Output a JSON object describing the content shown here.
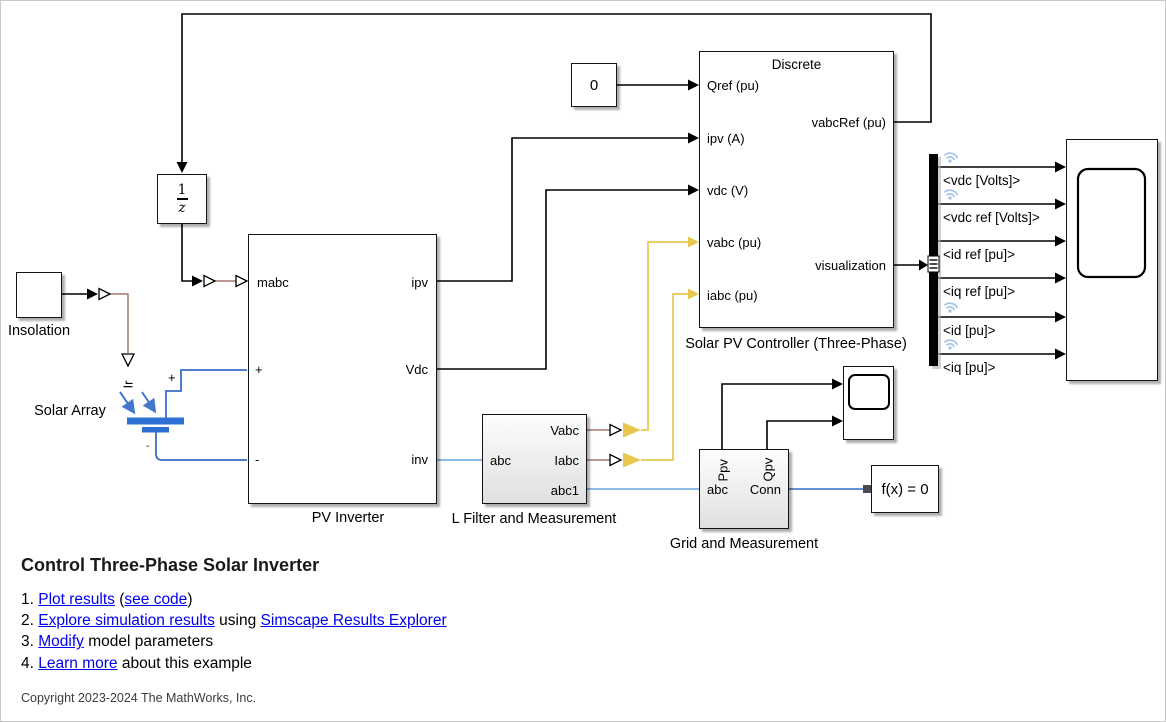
{
  "blocks": {
    "insolation": {
      "label": "Insolation"
    },
    "solar_array": {
      "label": "Solar Array",
      "ir_port": "Ir",
      "plus_label": "+",
      "minus_label": "-"
    },
    "unit_delay": {
      "numerator": "1",
      "denominator": "z"
    },
    "constant": {
      "value": "0"
    },
    "pv_inverter": {
      "label": "PV Inverter",
      "ports": {
        "mabc": "mabc",
        "plus": "+",
        "minus": "-",
        "ipv": "ipv",
        "vdc": "Vdc",
        "inv": "inv"
      }
    },
    "controller": {
      "label": "Solar PV Controller (Three-Phase)",
      "badge": "Discrete",
      "ports": {
        "qref": "Qref (pu)",
        "ipv": "ipv (A)",
        "vdc": "vdc (V)",
        "vabc": "vabc (pu)",
        "iabc": "iabc (pu)",
        "vabcref": "vabcRef (pu)",
        "visualization": "visualization"
      }
    },
    "l_filter": {
      "label": "L Filter and Measurement",
      "ports": {
        "abc": "abc",
        "vabc": "Vabc",
        "iabc": "Iabc",
        "abc1": "abc1"
      }
    },
    "grid": {
      "label": "Grid and Measurement",
      "ports": {
        "ppv": "Ppv",
        "qpv": "Qpv",
        "abc": "abc",
        "conn": "Conn"
      }
    },
    "solver": {
      "label": "f(x) = 0"
    }
  },
  "bus_signals": [
    "<vdc [Volts]>",
    "<vdc ref [Volts]>",
    "<id ref [pu]>",
    "<iq ref [pu]>",
    "<id [pu]>",
    "<iq [pu]>"
  ],
  "description": {
    "title": "Control Three-Phase Solar Inverter",
    "items": [
      {
        "num": "1.",
        "parts": [
          {
            "text": "Plot results",
            "link": true
          },
          {
            "text": " (",
            "link": false
          },
          {
            "text": "see code",
            "link": true
          },
          {
            "text": ")",
            "link": false
          }
        ]
      },
      {
        "num": "2.",
        "parts": [
          {
            "text": "Explore simulation results",
            "link": true
          },
          {
            "text": " using ",
            "link": false
          },
          {
            "text": "Simscape Results Explorer",
            "link": true
          }
        ]
      },
      {
        "num": "3.",
        "parts": [
          {
            "text": "Modify",
            "link": true
          },
          {
            "text": " model parameters",
            "link": false
          }
        ]
      },
      {
        "num": "4.",
        "parts": [
          {
            "text": "Learn more",
            "link": true
          },
          {
            "text": " about this example",
            "link": false
          }
        ]
      }
    ],
    "copyright": "Copyright 2023-2024 The MathWorks, Inc."
  },
  "colors": {
    "signal_black": "#000000",
    "physical_red": "#a5756e",
    "bus_yellow": "#e8c750",
    "three_phase_blue": "#7fb0e0",
    "solver_blue": "#4f81cc",
    "solar_blue": "#2e6fd4",
    "logging_badge_blue": "#a6c6e8",
    "link_blue": "#0000EE"
  }
}
